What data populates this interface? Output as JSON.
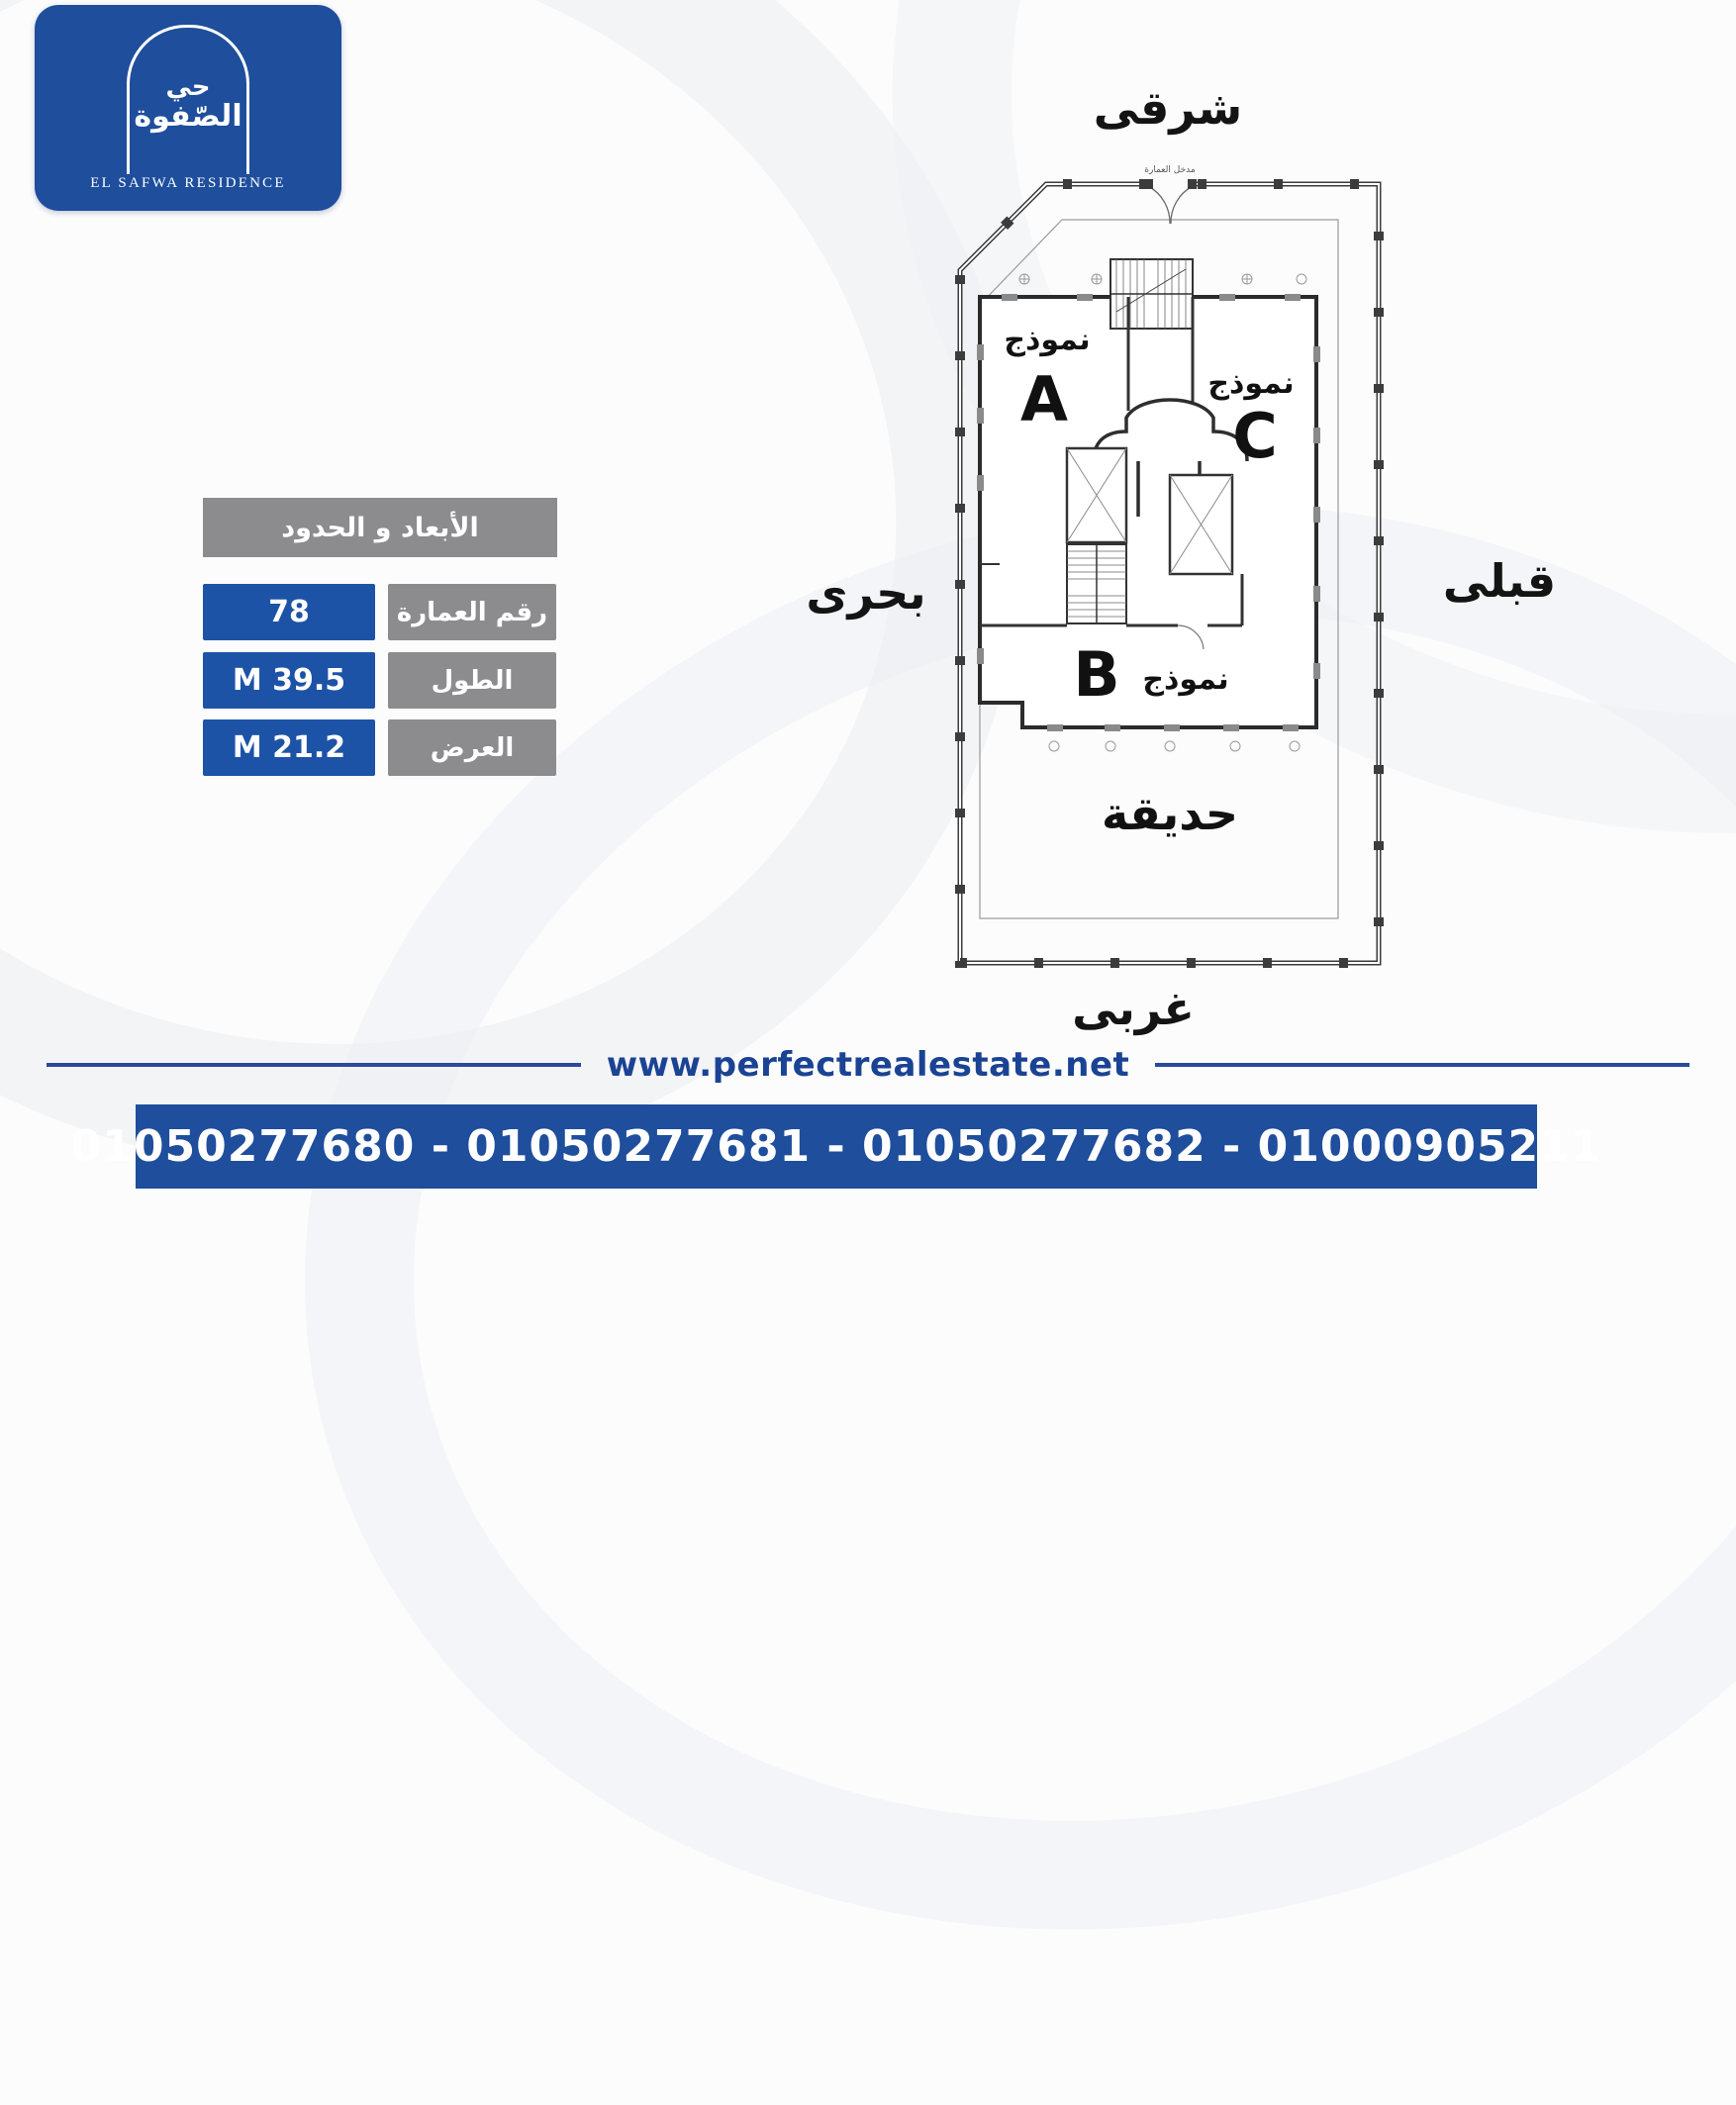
{
  "brand": {
    "logo_arabic_line1": "حي",
    "logo_arabic_line2": "الصّفوة",
    "caption": "EL SAFWA RESIDENCE"
  },
  "directions": {
    "east": "شرقى",
    "north": "بحرى",
    "south": "قبلى",
    "west": "غربى"
  },
  "info_table": {
    "header": "الأبعاد و الحدود",
    "rows": [
      {
        "label": "رقم العمارة",
        "value": "78"
      },
      {
        "label": "الطول",
        "value": "M 39.5"
      },
      {
        "label": "العرض",
        "value": "M 21.2"
      }
    ]
  },
  "floor_plan": {
    "entrance_label": "مدخل العمارة",
    "unit_word": "نموذج",
    "units": [
      {
        "letter": "A"
      },
      {
        "letter": "C"
      },
      {
        "letter": "B"
      }
    ],
    "garden_label": "حديقة"
  },
  "footer": {
    "website": "www.perfectrealestate.net",
    "phones": "01050277680 - 01050277681 - 01050277682 - 01000905211"
  },
  "colors": {
    "brand_blue": "#1e4e9c",
    "table_blue": "#1d53a6",
    "table_gray": "#8c8c8e",
    "url_navy": "#1b4394"
  }
}
